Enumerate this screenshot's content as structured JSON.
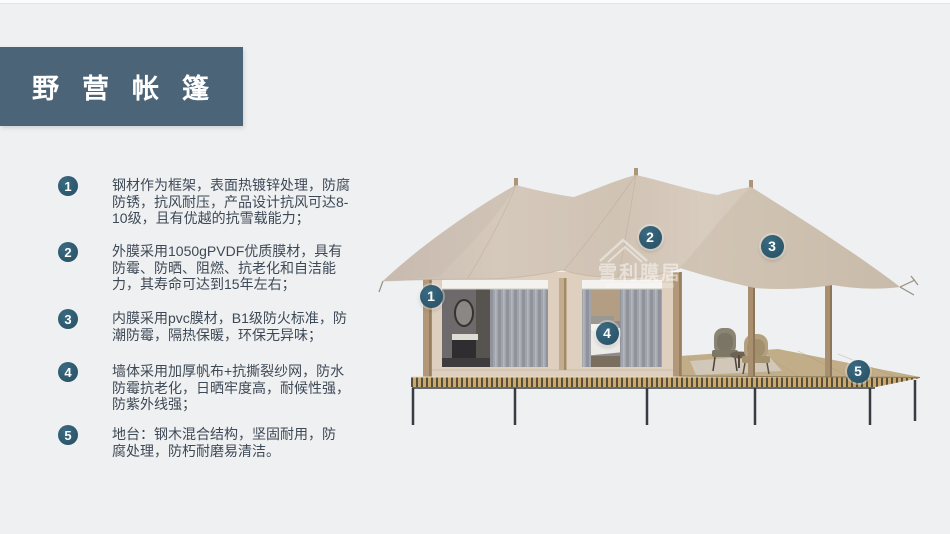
{
  "header": {
    "title": "野营帐篷"
  },
  "features": [
    {
      "number": "1",
      "text": "钢材作为框架，表面热镀锌处理，防腐\n防锈，抗风耐压，产品设计抗风可达8-\n10级，且有优越的抗雪载能力；"
    },
    {
      "number": "2",
      "text": "外膜采用1050gPVDF优质膜材，具有\n防霉、防晒、阻燃、抗老化和自洁能\n力，其寿命可达到15年左右；"
    },
    {
      "number": "3",
      "text": "内膜采用pvc膜材，B1级防火标准，防\n潮防霉，隔热保暖，环保无异味；"
    },
    {
      "number": "4",
      "text": "墙体采用加厚帆布+抗撕裂纱网，防水\n防霉抗老化，日晒牢度高，耐候性强，\n防紫外线强；"
    },
    {
      "number": "5",
      "text": "地台：钢木混合结构，坚固耐用，防\n腐处理，防朽耐磨易清洁。"
    }
  ],
  "illustration": {
    "watermark": {
      "brand": "雪利膜居"
    },
    "markers": [
      {
        "number": "1"
      },
      {
        "number": "2"
      },
      {
        "number": "3"
      },
      {
        "number": "4"
      },
      {
        "number": "5"
      }
    ]
  },
  "colors": {
    "bg": "#eff0f1",
    "bar": "#4c6477",
    "marker": "#2c566a",
    "text": "#3e4956",
    "canopy": "#d2c5b7",
    "wall": "#decfbf",
    "wood": "#b0987a",
    "deck": "#c2ad89"
  }
}
